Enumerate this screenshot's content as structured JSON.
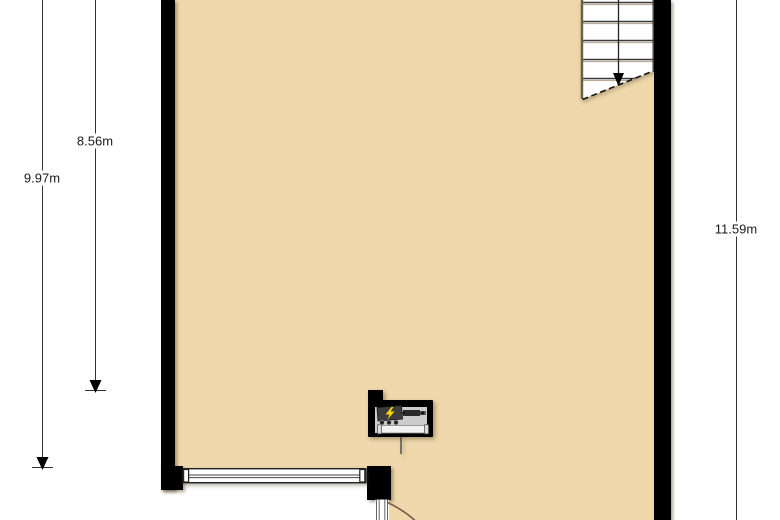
{
  "dimensions": {
    "left_inner": {
      "label": "8.56m"
    },
    "left_outer": {
      "label": "9.97m"
    },
    "right": {
      "label": "11.59m"
    }
  },
  "colors": {
    "floor": "#EFD8AC",
    "wall": "#000000",
    "dimension_line": "#333333",
    "dimension_text": "#1a1a1a",
    "door_arc": "#7a5b49",
    "stair_stringer": "#6e5f3f",
    "meter_panel": "#3d3d3d",
    "meter_body": "#cdcdcd",
    "lightning_accent": "#ffd400"
  },
  "fixtures": {
    "staircase": "staircase-going-down",
    "walk_line_arrow": "arrow-down-icon",
    "meter_box": "electric-meter-box",
    "lightning": "lightning-icon",
    "window": "window-in-bottom-wall",
    "door": "door-swing-arc"
  }
}
